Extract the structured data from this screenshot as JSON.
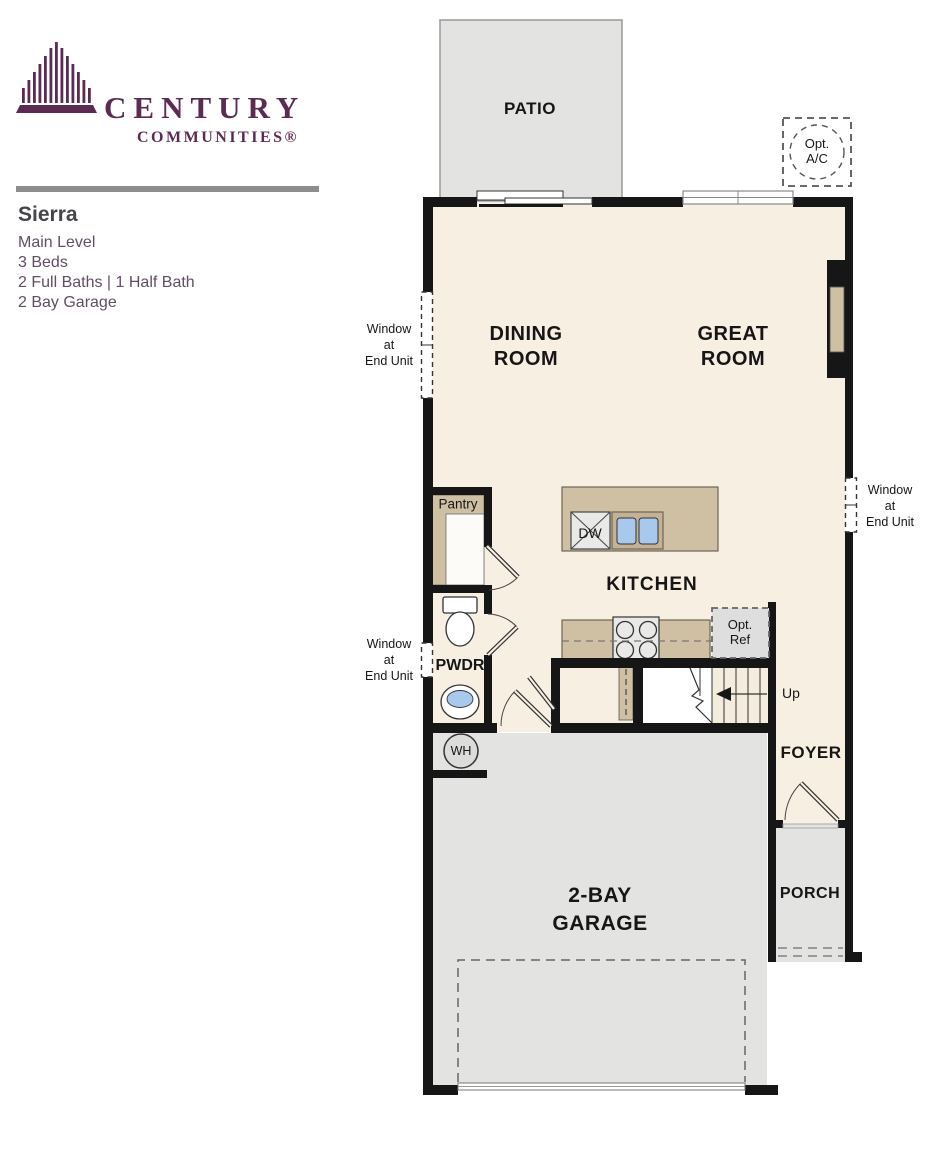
{
  "brand": {
    "logo_top": "CENTURY",
    "logo_bottom": "COMMUNITIES®"
  },
  "plan_info": {
    "title": "Sierra",
    "level": "Main Level",
    "beds": "3 Beds",
    "baths": "2 Full Baths | 1 Half Bath",
    "garage": "2 Bay Garage"
  },
  "rooms": {
    "patio": "PATIO",
    "dining": "DINING\nROOM",
    "great": "GREAT\nROOM",
    "kitchen": "KITCHEN",
    "pwdr": "PWDR",
    "foyer": "FOYER",
    "porch": "PORCH",
    "garage": "2-BAY\nGARAGE",
    "pantry": "Pantry"
  },
  "annotations": {
    "opt_ac": "Opt.\nA/C",
    "opt_ref": "Opt.\nRef",
    "dw": "DW",
    "wh": "WH",
    "up": "Up",
    "window_end_unit": "Window\nat\nEnd Unit"
  },
  "colors": {
    "brand_purple": "#5c2b52",
    "floor_cream": "#f7efe2",
    "concrete_gray": "#e3e3e1",
    "counter_tan": "#cfc0a4",
    "wall_black": "#161616",
    "fixture_blue": "#a9c9ec"
  }
}
